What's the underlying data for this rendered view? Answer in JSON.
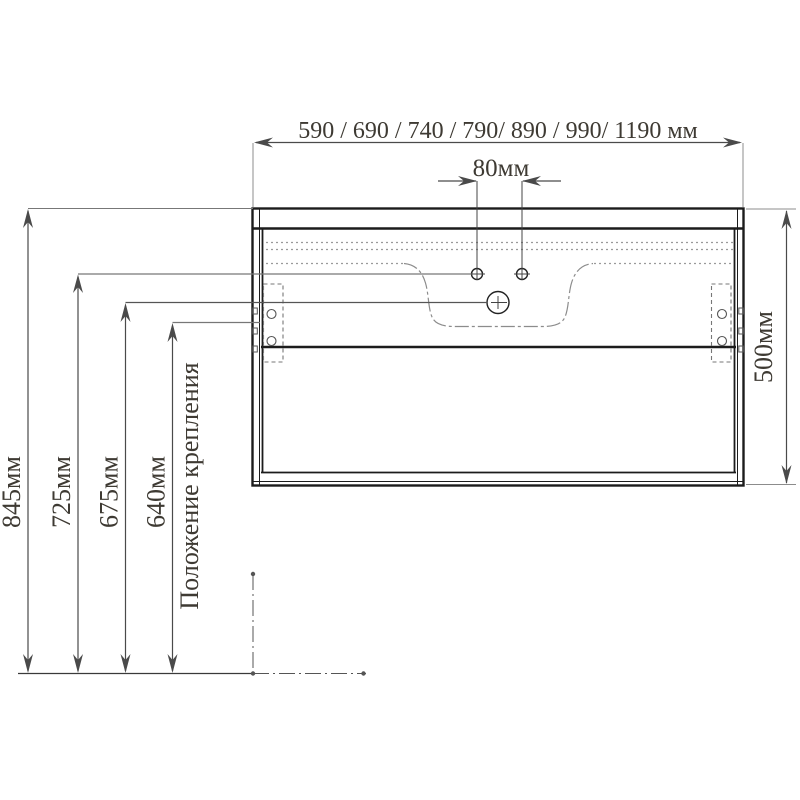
{
  "drawing": {
    "width_options_label": "590 / 690 / 740 / 790/ 890 / 990/ 1190 мм",
    "hole_spacing_label": "80мм",
    "height_label": "500мм",
    "mounting_position_label": "Положение крепления",
    "floor_heights": [
      {
        "label": "845мм"
      },
      {
        "label": "725мм"
      },
      {
        "label": "675мм"
      },
      {
        "label": "640мм"
      }
    ]
  },
  "colors": {
    "main_line": "#1c1c1c",
    "aux_line": "#8c8c8c",
    "dim_line": "#4a4a4a",
    "text": "#3e3a33",
    "background": "#ffffff"
  }
}
